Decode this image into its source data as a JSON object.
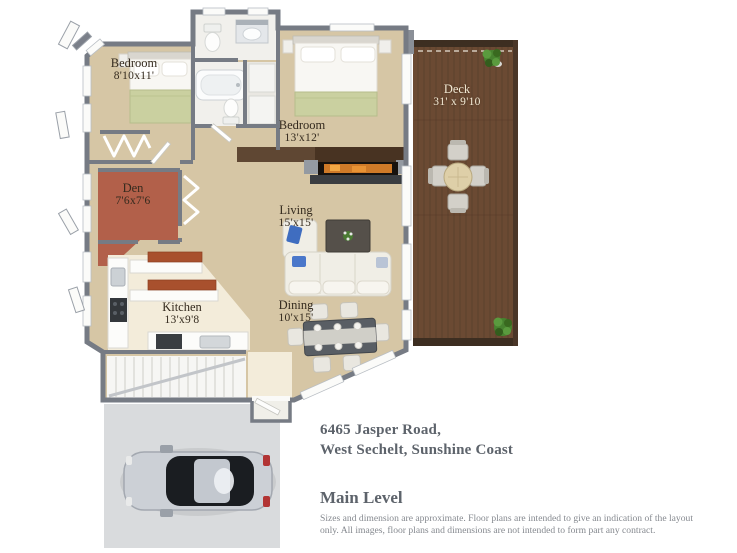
{
  "floor_plan": {
    "rooms": [
      {
        "id": "bedroom-1",
        "name": "Bedroom",
        "dims": "8'10x11'"
      },
      {
        "id": "bedroom-2",
        "name": "Bedroom",
        "dims": "13'x12'"
      },
      {
        "id": "den",
        "name": "Den",
        "dims": "7'6x7'6"
      },
      {
        "id": "living",
        "name": "Living",
        "dims": "15'x15'"
      },
      {
        "id": "kitchen",
        "name": "Kitchen",
        "dims": "13'x9'8"
      },
      {
        "id": "dining",
        "name": "Dining",
        "dims": "10'x15'"
      },
      {
        "id": "deck",
        "name": "Deck",
        "dims": "31' x 9'10"
      }
    ]
  },
  "address": {
    "line1": "6465 Jasper Road,",
    "line2": "West Sechelt, Sunshine Coast"
  },
  "level": {
    "title": "Main Level",
    "disclaimer": "Sizes and dimension are approximate. Floor plans are intended to give an indication of the layout only. All images, floor plans and dimensions are not intended to form part any contract."
  },
  "colors": {
    "wall_gray": "#767b84",
    "floor_tan": "#d6c6a5",
    "floor_kitchen": "#f3ecda",
    "floor_den": "#b2604a",
    "deck_wood": "#6b4a33",
    "counter_accent": "#a8502d",
    "label_dark": "#342a1e",
    "label_light": "#f2e9d4",
    "text_gray": "#5d636b",
    "disclaimer_gray": "#85898f"
  }
}
